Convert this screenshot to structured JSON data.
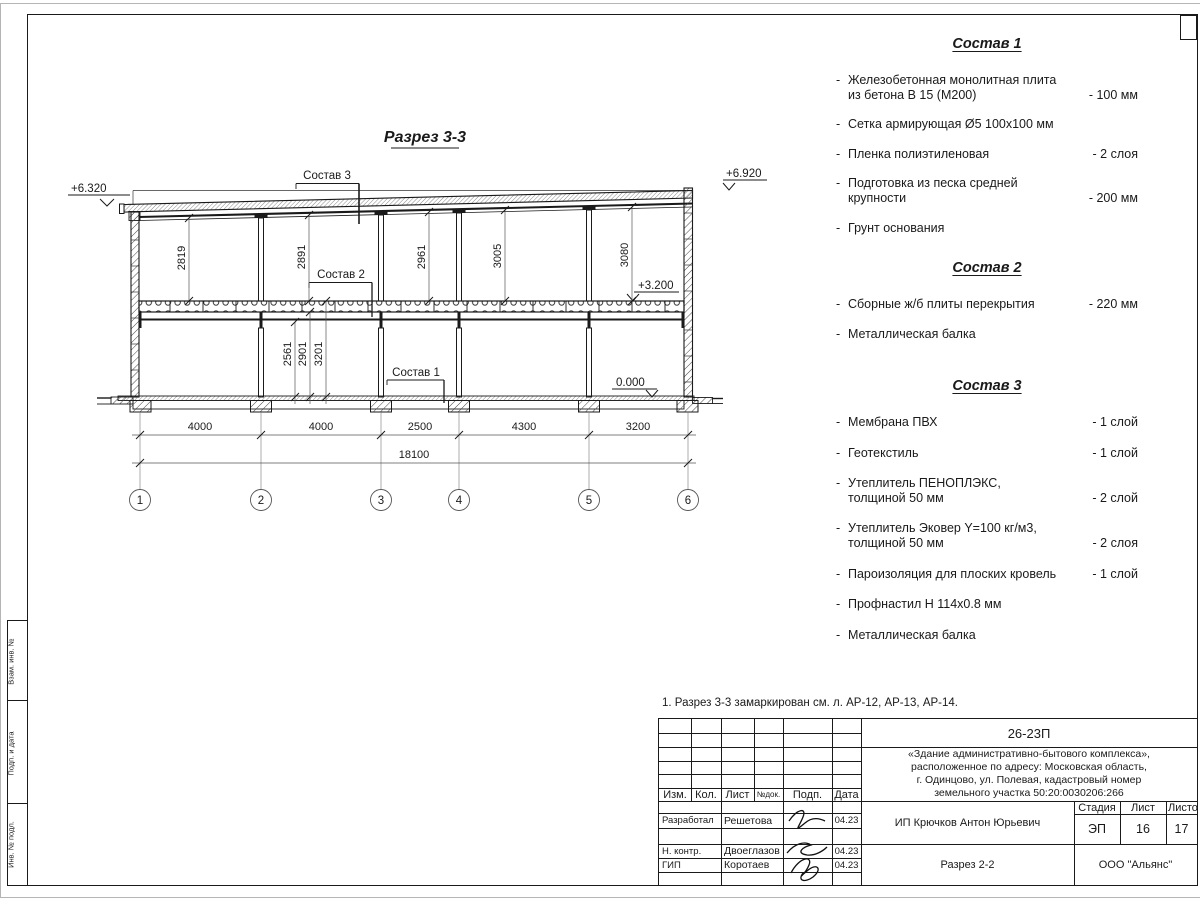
{
  "section": {
    "title": "Разрез 3-3",
    "elevations": {
      "top_left": "+6.320",
      "top_right": "+6.920",
      "floor2": "+3.200",
      "zero": "0.000"
    },
    "callouts": {
      "sostav1": "Состав 1",
      "sostav2": "Состав 2",
      "sostav3": "Состав 3"
    },
    "upper_heights": [
      "2819",
      "2891",
      "2961",
      "3005",
      "3080"
    ],
    "lower_heights": [
      "2561",
      "2901",
      "3201"
    ],
    "span_dims": [
      "4000",
      "4000",
      "2500",
      "4300",
      "3200"
    ],
    "total_dim": "18100",
    "axes": [
      "1",
      "2",
      "3",
      "4",
      "5",
      "6"
    ]
  },
  "compositions": [
    {
      "title": "Состав 1",
      "items": [
        {
          "l1": "Железобетонная  монолитная плита",
          "l2": "из бетона В 15 (М200)",
          "val": "- 100 мм"
        },
        {
          "l1": "Сетка армирующая Ø5 100х100 мм"
        },
        {
          "l1": "Пленка полиэтиленовая",
          "val": "-  2 слоя"
        },
        {
          "l1": "Подготовка из песка средней",
          "l2": "крупности",
          "val": "- 200 мм"
        },
        {
          "l1": "Грунт основания"
        }
      ]
    },
    {
      "title": "Состав 2",
      "items": [
        {
          "l1": "Сборные ж/б плиты перекрытия",
          "val": "- 220 мм"
        },
        {
          "l1": "Металлическая балка"
        }
      ]
    },
    {
      "title": "Состав 3",
      "items": [
        {
          "l1": "Мембрана ПВХ",
          "val": "- 1 слой"
        },
        {
          "l1": "Геотекстиль",
          "val": "- 1 слой"
        },
        {
          "l1": "Утеплитель ПЕНОПЛЭКС,",
          "l2": "толщиной 50 мм",
          "val": "- 2 слой"
        },
        {
          "l1": "Утеплитель Эковер Y=100 кг/м3,",
          "l2": "толщиной 50 мм",
          "val": "- 2 слоя"
        },
        {
          "l1": "Пароизоляция для плоских кровель",
          "val": "- 1 слой"
        },
        {
          "l1": "Профнастил Н 114х0.8 мм"
        },
        {
          "l1": "Металлическая балка"
        }
      ]
    }
  ],
  "note": "1. Разрез 3-3 замаркирован см. л. АР-12, АР-13, АР-14.",
  "titleblock": {
    "doc_code": "26-23П",
    "project_desc_1": "«Здание административно-бытового комплекса»,",
    "project_desc_2": "расположенное по адресу: Московская область,",
    "project_desc_3": "г. Одинцово, ул. Полевая, кадастровый номер",
    "project_desc_4": "земельного участка 50:20:0030206:266",
    "col_izm": "Изм.",
    "col_kol": "Кол.",
    "col_list": "Лист",
    "col_ndok": "№док.",
    "col_podp": "Подп.",
    "col_data": "Дата",
    "role_1": "Разработал",
    "name_1": "Решетова",
    "date_1": "04.23",
    "role_2": "Н. контр.",
    "name_2": "Двоеглазов",
    "date_2": "04.23",
    "role_3": "ГИП",
    "name_3": "Коротаев",
    "date_3": "04.23",
    "client": "ИП Крючков Антон Юрьевич",
    "stage_label": "Стадия",
    "sheet_label": "Лист",
    "sheets_label": "Листов",
    "stage": "ЭП",
    "sheet": "16",
    "sheets": "17",
    "view_name": "Разрез 2-2",
    "company": "ООО \"Альянс\""
  },
  "left_margin": {
    "cell_1": "Взам. инв. №",
    "cell_2": "Подп. и дата",
    "cell_3": "Инв. № подл."
  }
}
